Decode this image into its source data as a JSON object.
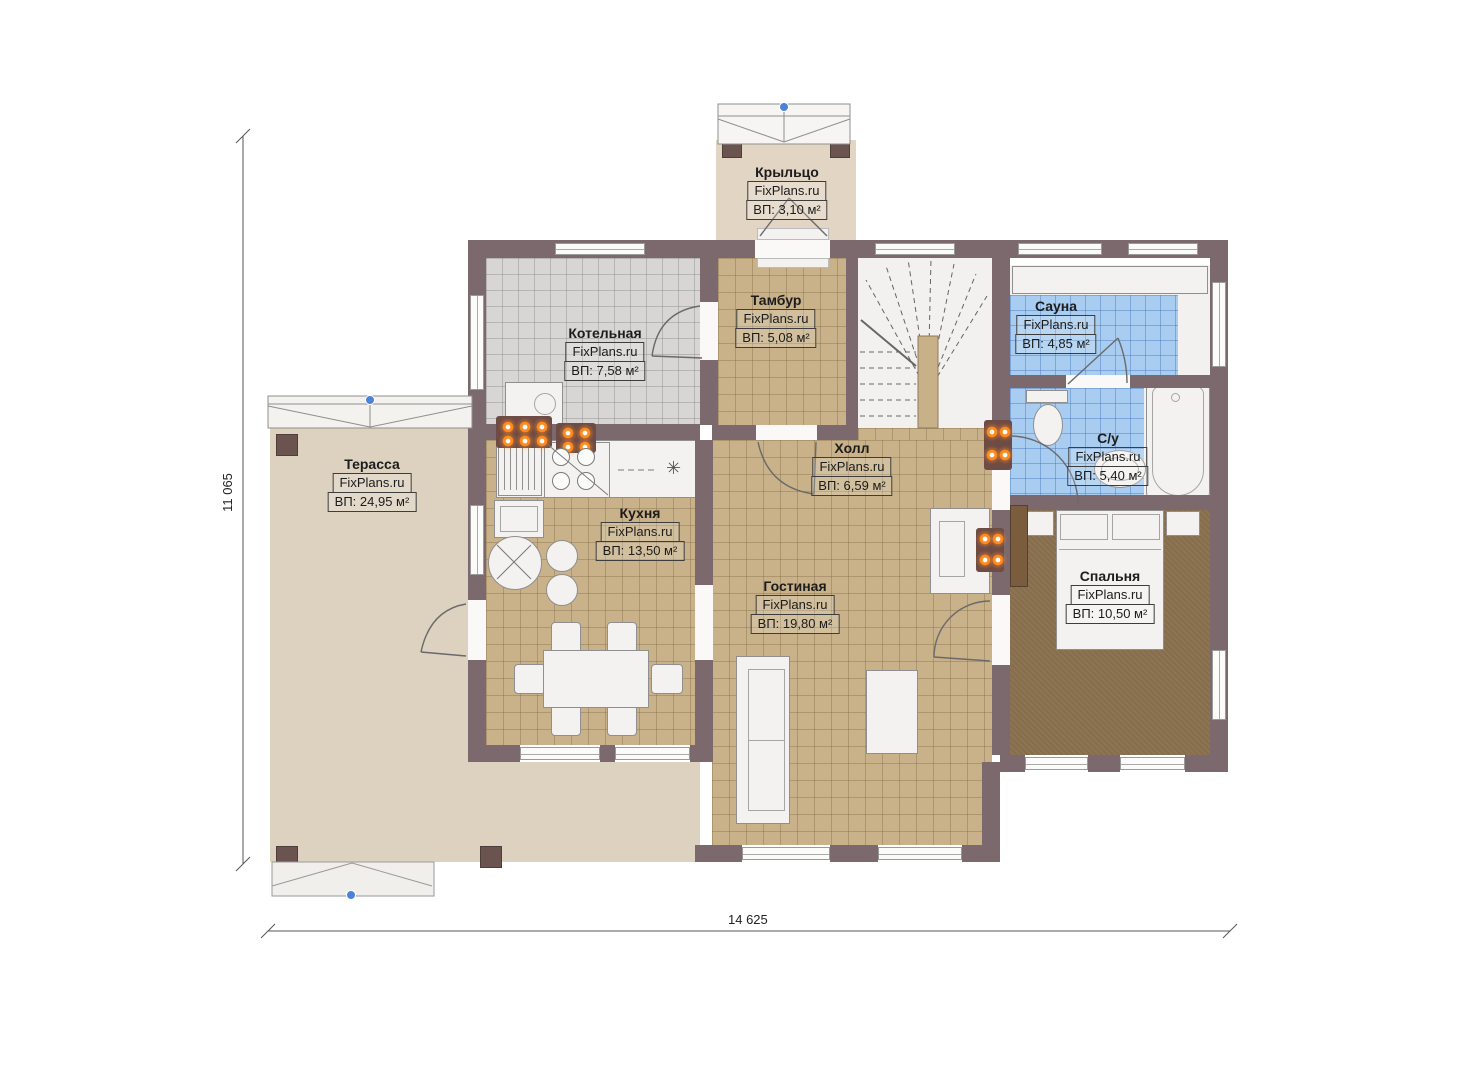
{
  "brand": "FixPlans.ru",
  "dimensions": {
    "height_label": "11 065",
    "width_label": "14 625"
  },
  "rooms": [
    {
      "id": "porch",
      "name": "Крыльцо",
      "brand": "FixPlans.ru",
      "area": "ВП: 3,10 м²"
    },
    {
      "id": "boiler",
      "name": "Котельная",
      "brand": "FixPlans.ru",
      "area": "ВП: 7,58 м²"
    },
    {
      "id": "tambour",
      "name": "Тамбур",
      "brand": "FixPlans.ru",
      "area": "ВП: 5,08 м²"
    },
    {
      "id": "sauna",
      "name": "Сауна",
      "brand": "FixPlans.ru",
      "area": "ВП: 4,85 м²"
    },
    {
      "id": "bathroom",
      "name": "С/у",
      "brand": "FixPlans.ru",
      "area": "ВП: 5,40 м²"
    },
    {
      "id": "terrace",
      "name": "Терасса",
      "brand": "FixPlans.ru",
      "area": "ВП: 24,95 м²"
    },
    {
      "id": "hall",
      "name": "Холл",
      "brand": "FixPlans.ru",
      "area": "ВП: 6,59 м²"
    },
    {
      "id": "kitchen",
      "name": "Кухня",
      "brand": "FixPlans.ru",
      "area": "ВП: 13,50 м²"
    },
    {
      "id": "living",
      "name": "Гостиная",
      "brand": "FixPlans.ru",
      "area": "ВП: 19,80 м²"
    },
    {
      "id": "bedroom",
      "name": "Спальня",
      "brand": "FixPlans.ru",
      "area": "ВП: 10,50 м²"
    }
  ],
  "icons": {
    "snowflake": "✳"
  },
  "colors": {
    "wall": "#7c696d",
    "floor_tan": "#c9b189",
    "floor_gray": "#d8d6d4",
    "floor_blue": "#a9cdf0",
    "terrace": "#ddd1bf",
    "carpet": "#8d7452",
    "fixture_white": "#f3f2f0",
    "radiator_orange": "#ff8a1e",
    "handle_blue": "#4d82d8"
  }
}
